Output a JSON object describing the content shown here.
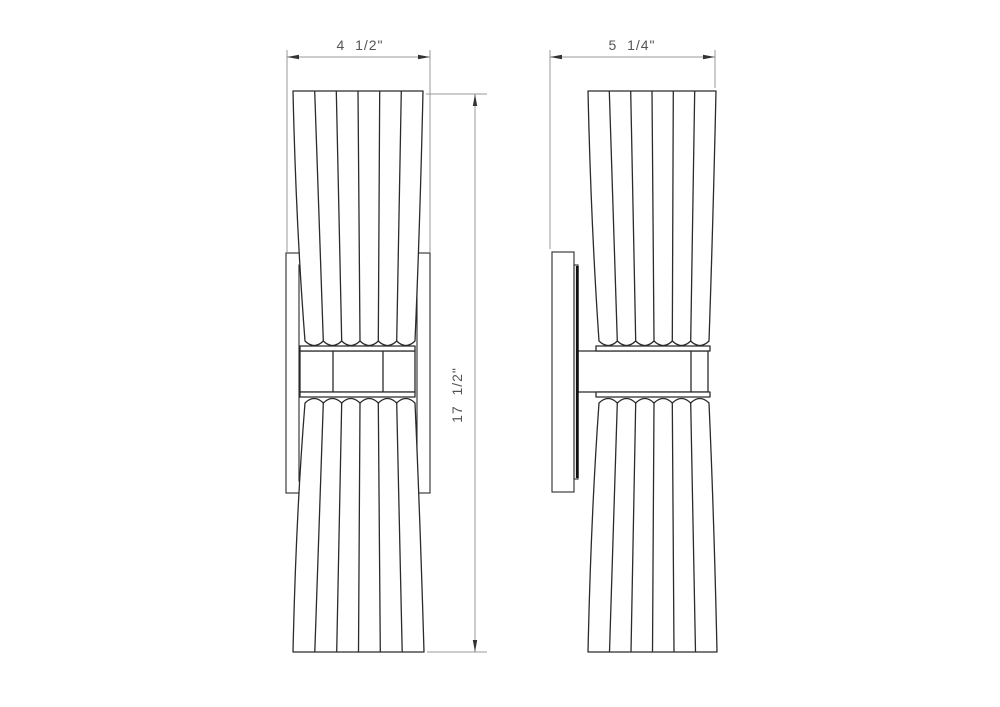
{
  "drawing": {
    "type": "technical-line-drawing",
    "subject": "two-light wall sconce, front and side elevation views",
    "background_color": "#ffffff",
    "colors": {
      "object_line": "#2b2b2b",
      "thick_object_line": "#101010",
      "dimension_line": "#999999",
      "dimension_text": "#555555",
      "arrowhead": "#333333"
    },
    "views": [
      {
        "id": "front-view",
        "position": "left"
      },
      {
        "id": "side-view",
        "position": "right"
      }
    ],
    "dimensions": {
      "front_width": "4  1/2\"",
      "side_depth": "5  1/4\"",
      "overall_height": "17  1/2\""
    }
  }
}
